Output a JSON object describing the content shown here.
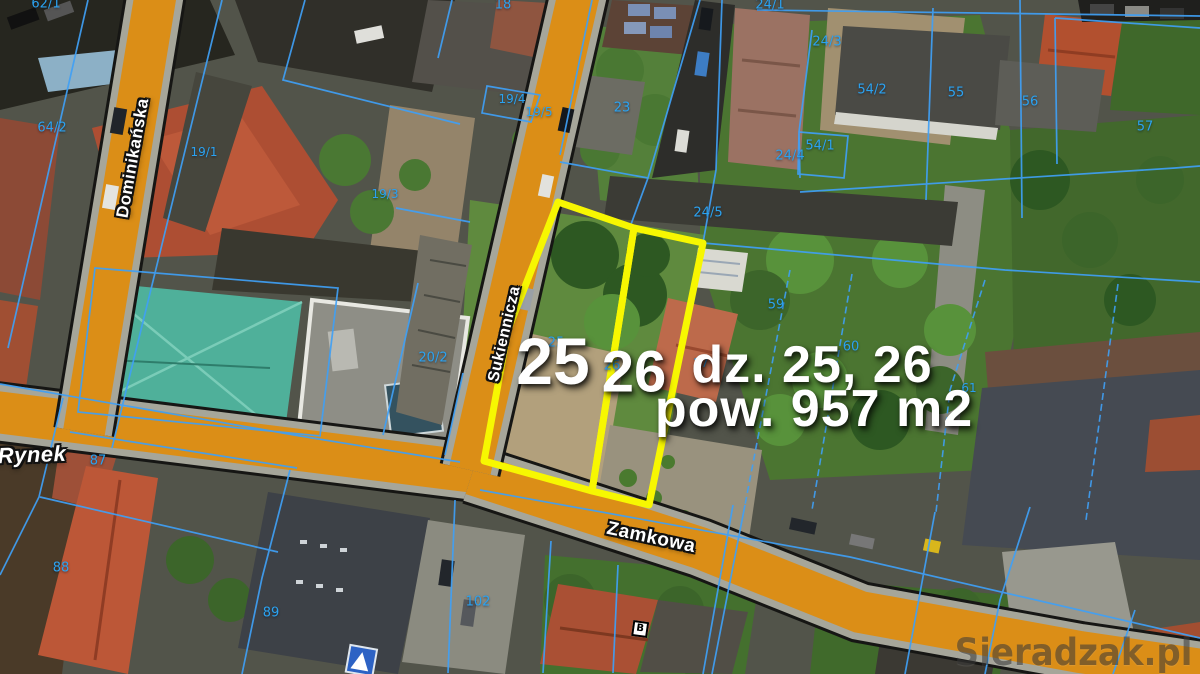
{
  "map": {
    "street_labels": [
      {
        "text": "Dominikańska",
        "x": 133,
        "y": 158,
        "rotate": -80,
        "size": 17,
        "italic": false
      },
      {
        "text": "Sukiennicza",
        "x": 505,
        "y": 334,
        "rotate": -77,
        "size": 16,
        "italic": false
      },
      {
        "text": "Zamkowa",
        "x": 651,
        "y": 538,
        "rotate": 12,
        "size": 19,
        "italic": false
      },
      {
        "text": "Rynek",
        "x": 32,
        "y": 455,
        "rotate": -2,
        "size": 22,
        "italic": true
      }
    ],
    "parcel_numbers": [
      {
        "text": "62/1",
        "x": 46,
        "y": 4,
        "size": 13
      },
      {
        "text": "64/2",
        "x": 52,
        "y": 128,
        "size": 13
      },
      {
        "text": "19/1",
        "x": 204,
        "y": 152,
        "size": 12
      },
      {
        "text": "19/3",
        "x": 385,
        "y": 194,
        "size": 12
      },
      {
        "text": "18",
        "x": 503,
        "y": 5,
        "size": 13
      },
      {
        "text": "19/4",
        "x": 512,
        "y": 99,
        "size": 12
      },
      {
        "text": "19/5",
        "x": 539,
        "y": 112,
        "size": 12
      },
      {
        "text": "23",
        "x": 622,
        "y": 108,
        "size": 13
      },
      {
        "text": "24/1",
        "x": 770,
        "y": 5,
        "size": 13
      },
      {
        "text": "24/3",
        "x": 827,
        "y": 42,
        "size": 13
      },
      {
        "text": "54/2",
        "x": 872,
        "y": 90,
        "size": 13
      },
      {
        "text": "55",
        "x": 956,
        "y": 93,
        "size": 13
      },
      {
        "text": "56",
        "x": 1030,
        "y": 102,
        "size": 13
      },
      {
        "text": "57",
        "x": 1145,
        "y": 127,
        "size": 13
      },
      {
        "text": "54/1",
        "x": 820,
        "y": 146,
        "size": 13
      },
      {
        "text": "24/4",
        "x": 790,
        "y": 156,
        "size": 13
      },
      {
        "text": "24/5",
        "x": 708,
        "y": 213,
        "size": 13
      },
      {
        "text": "59",
        "x": 776,
        "y": 305,
        "size": 13
      },
      {
        "text": "60",
        "x": 851,
        "y": 347,
        "size": 13
      },
      {
        "text": "61",
        "x": 969,
        "y": 388,
        "size": 12
      },
      {
        "text": "27",
        "x": 701,
        "y": 363,
        "size": 12
      },
      {
        "text": "25",
        "x": 556,
        "y": 343,
        "size": 13
      },
      {
        "text": "26",
        "x": 612,
        "y": 366,
        "size": 13
      },
      {
        "text": "20/2",
        "x": 433,
        "y": 358,
        "size": 13
      },
      {
        "text": "87",
        "x": 98,
        "y": 461,
        "size": 13
      },
      {
        "text": "88",
        "x": 61,
        "y": 568,
        "size": 13
      },
      {
        "text": "89",
        "x": 271,
        "y": 613,
        "size": 13
      },
      {
        "text": "102",
        "x": 478,
        "y": 602,
        "size": 13
      }
    ],
    "building_label": {
      "text": "B"
    },
    "annotation": {
      "parcel25": "25",
      "parcel26": "26",
      "line1": "dz. 25, 26",
      "line2": "pow. 957 m2"
    },
    "watermark": "Sieradzak.pl",
    "colors": {
      "street_orange": "#db8e17",
      "cadastral_blue": "#3fa0f5",
      "parcel_highlight_yellow": "#f7f701",
      "parcel_number_cyan": "#2ba2f0",
      "annotation_white": "#ffffff",
      "watermark_gray": "#383838"
    }
  }
}
